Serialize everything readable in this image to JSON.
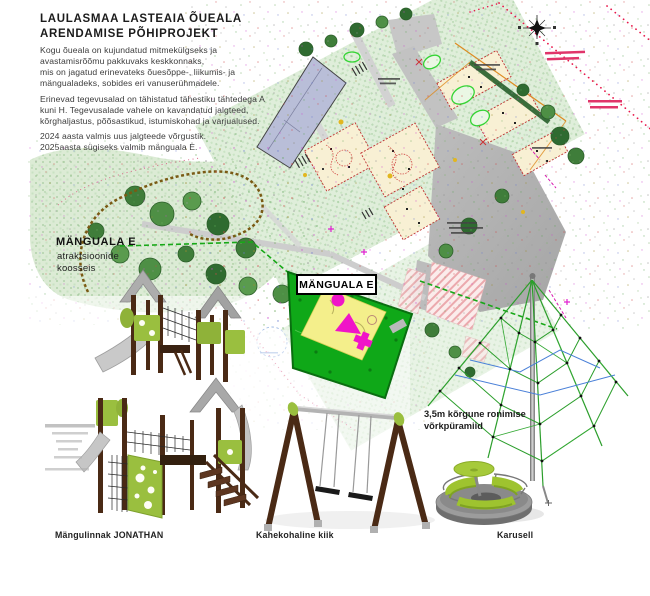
{
  "header": {
    "title_line1": "LAULASMAA LASTEAIA ÕUEALA",
    "title_line2": "ARENDAMISE PÕHIPROJEKT",
    "paragraph1": "Kogu õueala on kujundatud mitmekülgseks ja\navastamisrõõmu pakkuvaks keskkonnaks,\nmis on jagatud erinevateks õuesõppe-, liikumis- ja\nmängualadeks, sobides eri vanuserühmadele.",
    "paragraph2": "Erinevad tegevusalad on tähistatud tähestiku tähtedega A\nkuni H. Tegevusalade vahele on kavandatud jalgteed,\nkõrghaljastus, põõsastikud, istumiskohad ja varjualused.",
    "paragraph3": "2024 aasta valmis uus jalgteede võrgustik.\n2025aasta sügiseks valmib mänguala E."
  },
  "annotations": {
    "playarea_callout_title": "MÄNGUALA E",
    "playarea_callout_subtitle": "atraktsioonide\nkoosseis",
    "map_area_label": "MÄNGUALA E",
    "pyramid_label": "3,5m kõrgune ronimise\nvõrkpüramiid"
  },
  "equipment": {
    "castle_label": "Mängulinnak JONATHAN",
    "swing_label": "Kahekohaline kiik",
    "carousel_label": "Karusell"
  },
  "icons": {
    "north_arrow": "✳"
  },
  "colors": {
    "highlight_green": "#0fa818",
    "highlight_yellow": "#f4ef8b",
    "shape_magenta": "#f014c8",
    "building_fill": "#b9bed8",
    "road_gray": "#b6b6b6",
    "boundary_red": "#e8174a",
    "equipment_green": "#9abf3f",
    "wood_brown": "#4a2a15",
    "net_green": "#2b9e2b",
    "vegetation_light": "#dfeeda",
    "tree_dark": "#2f6b30"
  }
}
